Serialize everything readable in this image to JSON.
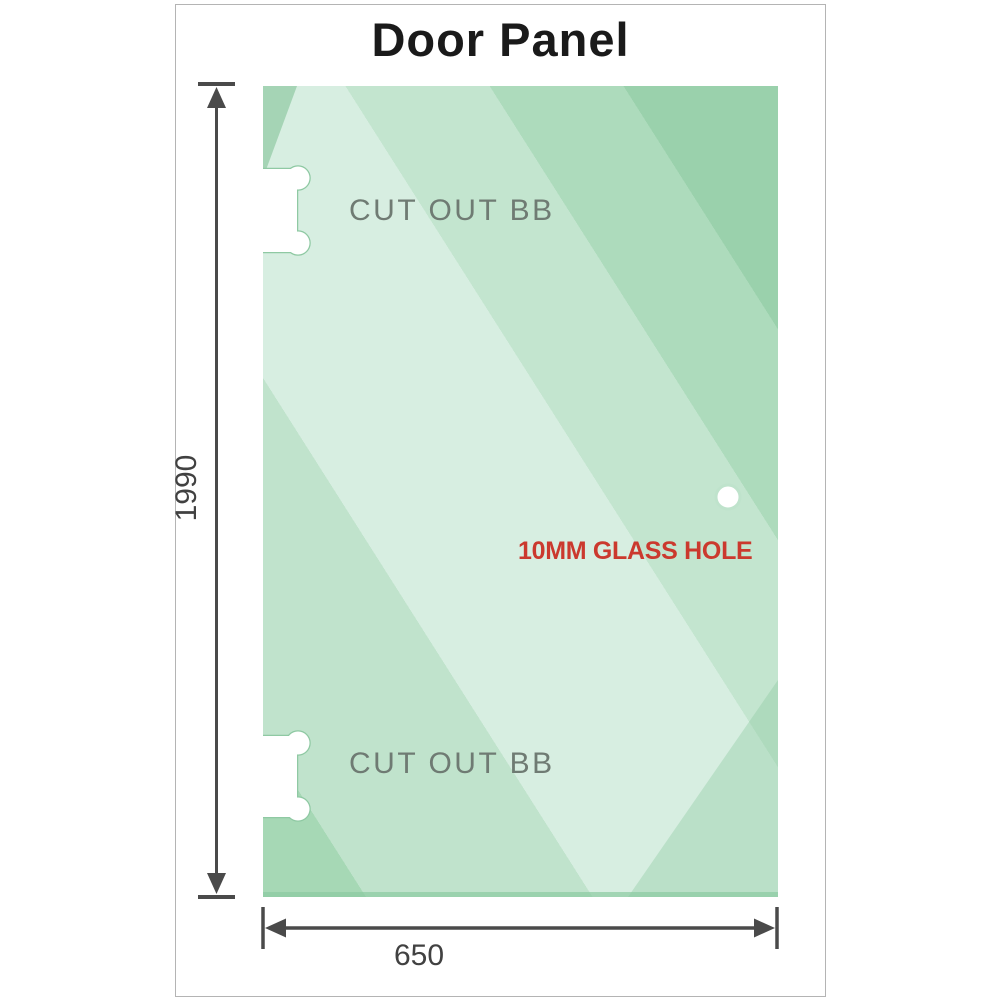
{
  "title": "Door Panel",
  "panel": {
    "cutout_top_label": "CUT OUT BB",
    "cutout_bottom_label": "CUT OUT BB",
    "hole_label": "10MM GLASS HOLE"
  },
  "dimensions": {
    "height_value": "1990",
    "width_value": "650"
  },
  "colors": {
    "glass_base": "#9ad1ac",
    "glass_light": "#d7eee1",
    "cutout_outline": "#8fc9a3",
    "dimension_line": "#4a4a4a",
    "hole_label_red": "#cb392e",
    "cutout_label_gray": "#6f7b73",
    "frame_border": "#b4b4b4"
  }
}
